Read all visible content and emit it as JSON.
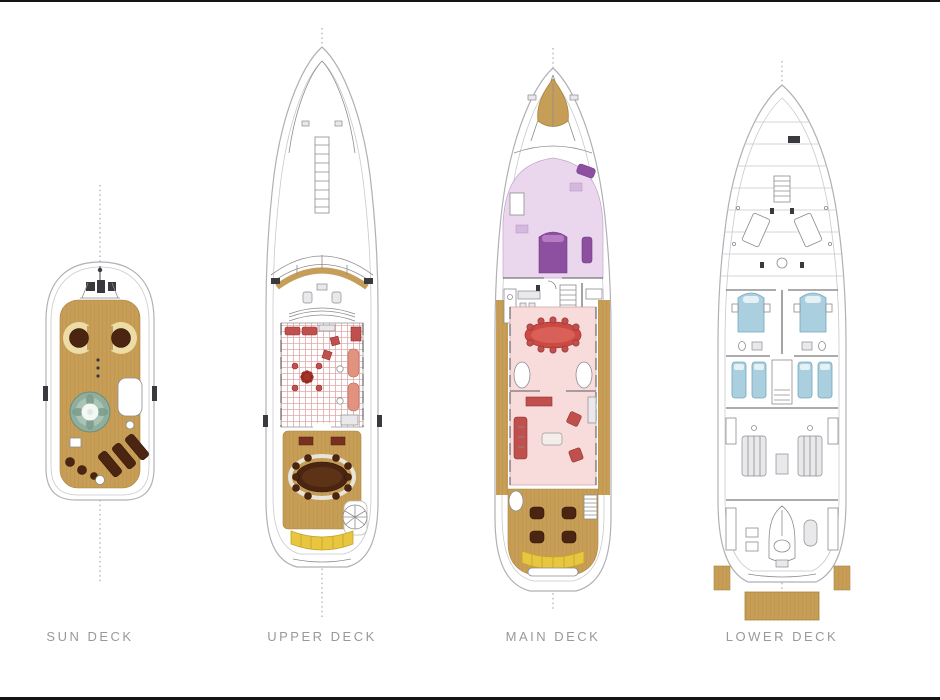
{
  "page": {
    "background": "#ffffff",
    "frame_color": "#141414"
  },
  "diagram": {
    "type": "yacht-deck-plans",
    "decks": [
      {
        "id": "sun-deck",
        "label": "SUN DECK",
        "features": [
          "mast",
          "circular-lounges",
          "jacuzzi",
          "sun-pads",
          "teak-deck"
        ]
      },
      {
        "id": "upper-deck",
        "label": "UPPER DECK",
        "features": [
          "bow-ladder",
          "helm-console",
          "skylounge",
          "al-fresco-dining-table",
          "stern-bench",
          "spiral-staircase"
        ]
      },
      {
        "id": "main-deck",
        "label": "MAIN DECK",
        "features": [
          "bow-seat",
          "master-stateroom",
          "dining-table",
          "salon",
          "aft-deck-chairs",
          "stern-bench"
        ]
      },
      {
        "id": "lower-deck",
        "label": "LOWER DECK",
        "features": [
          "crew-quarters",
          "vip-cabins",
          "twin-cabins",
          "engine-room",
          "tender-garage",
          "swim-platform"
        ]
      }
    ],
    "colors": {
      "hull-line": "#b0b0b6",
      "inner-line": "#c9c9ce",
      "wall": "#5a5a5e",
      "teak": "#c79e58",
      "teak-line": "#a9823f",
      "cream": "#eddca6",
      "dark-brown": "#4b2512",
      "jacuzzi-teal": "#8fae9d",
      "carpet-pink": "#e0a8a8",
      "furniture-red": "#c0504d",
      "furniture-salmon": "#e2937f",
      "salon-pink": "#f8dcdc",
      "lavender": "#ead7ee",
      "purple": "#8d4fa0",
      "bed-blue": "#aacfdf",
      "bench-yellow": "#e9c63f",
      "label-gray": "#999999",
      "centerline": "#9a9a9a",
      "detail-gray": "#8c8c90",
      "frame": "#141414"
    }
  }
}
